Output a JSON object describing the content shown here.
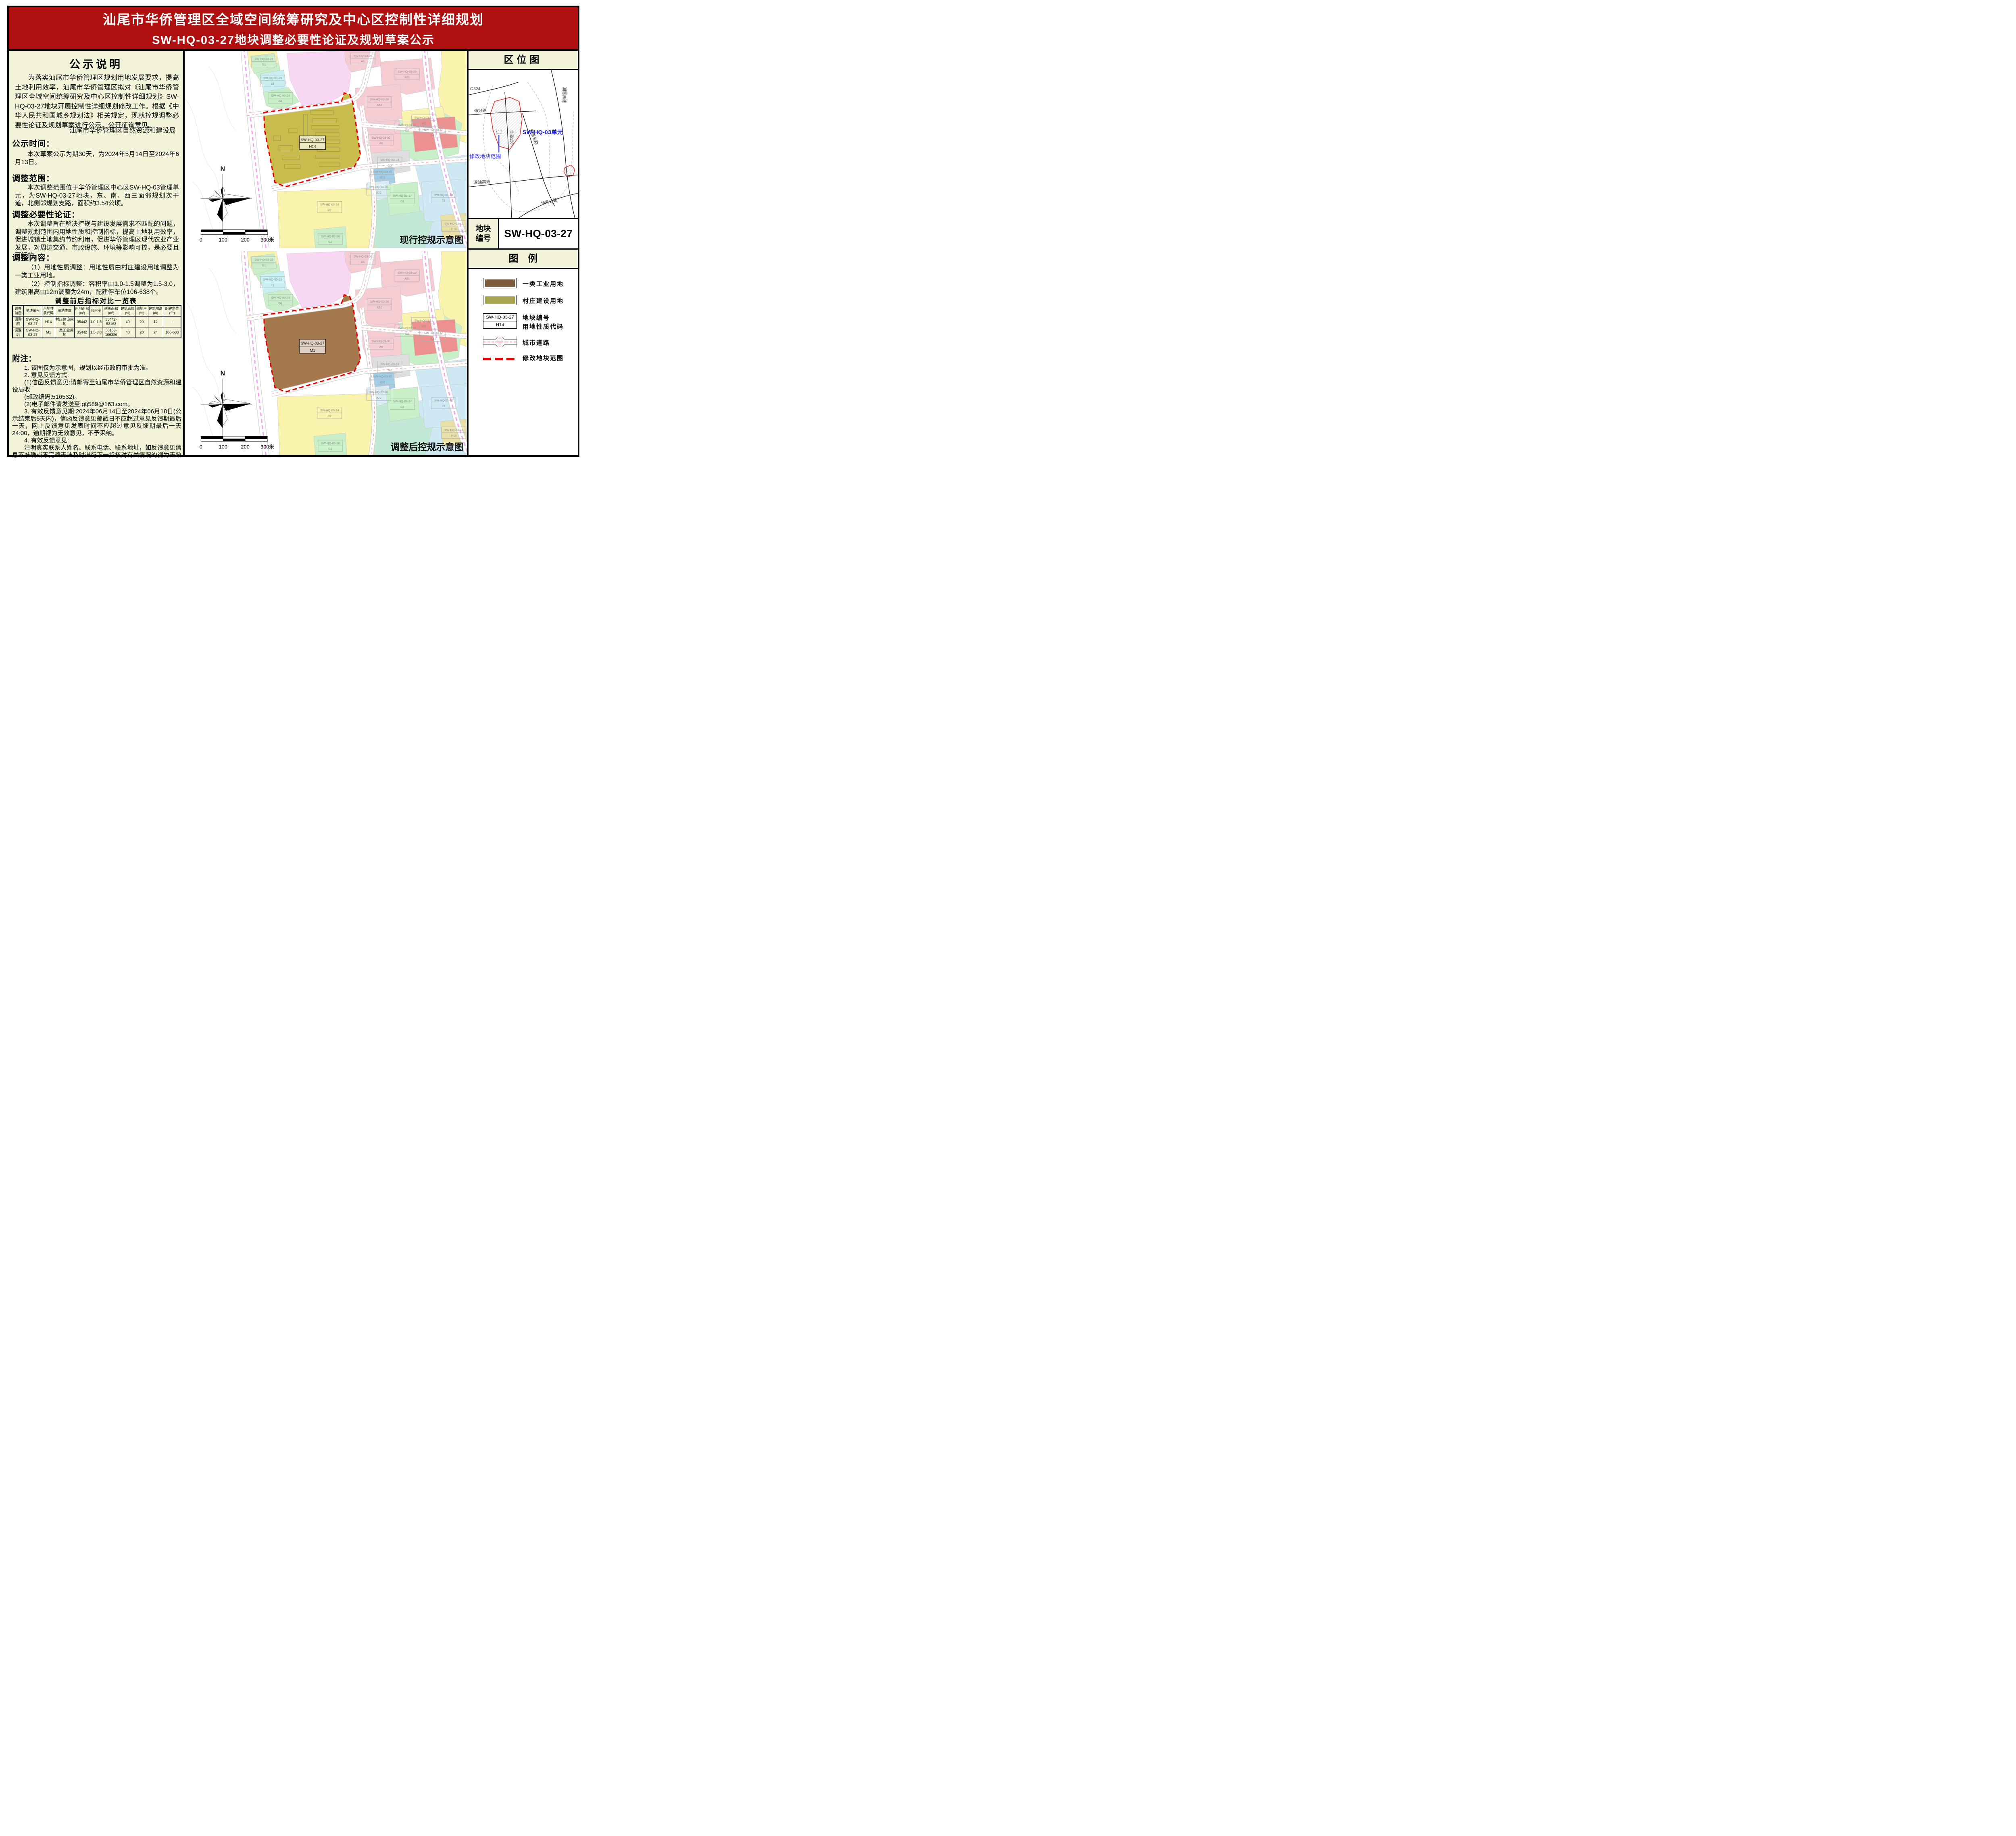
{
  "colors": {
    "header_red": "#b01010",
    "panel_cream": "#f2f3d8",
    "industrial_brown": "#7f5a3a",
    "village_olive": "#a9a44e",
    "map_olive": "#c9bc4c",
    "map_brown": "#a5794e",
    "boundary_red": "#e60000",
    "blue_label": "#1a1ae6"
  },
  "header": {
    "title_line1": "汕尾市华侨管理区全域空间统筹研究及中心区控制性详细规划",
    "title_line2": "SW-HQ-03-27地块调整必要性论证及规划草案公示"
  },
  "left": {
    "notice_title": "公示说明",
    "intro": "为落实汕尾市华侨管理区规划用地发展要求，提高土地利用效率，汕尾市华侨管理区拟对《汕尾市华侨管理区全域空间统筹研究及中心区控制性详细规划》SW-HQ-03-27地块开展控制性详细规划修改工作。根据《中华人民共和国城乡规划法》相关规定，现就控规调整必要性论证及规划草案进行公示，公开征询意见。",
    "agency": "汕尾市华侨管理区自然资源和建设局",
    "sections": [
      {
        "heading": "公示时间：",
        "body": "本次草案公示为期30天，为2024年5月14日至2024年6月13日。"
      },
      {
        "heading": "调整范围：",
        "body": "本次调整范围位于华侨管理区中心区SW-HQ-03管理单元，为SW-HQ-03-27地块，东、南、西三面邻规划次干道，北侧邻规划支路，面积约3.54公顷。"
      },
      {
        "heading": "调整必要性论证：",
        "body": "本次调整旨在解决控规与建设发展需求不匹配的问题，调整规划范围内用地性质和控制指标，提高土地利用效率，促进城镇土地集约节约利用，促进华侨管理区现代农业产业发展，对周边交通、市政设施、环境等影响可控，是必要且可行的。"
      }
    ],
    "adjust_content": {
      "heading": "调整内容：",
      "lines": [
        "（1）用地性质调整：用地性质由村庄建设用地调整为一类工业用地。",
        "（2）控制指标调整：容积率由1.0-1.5调整为1.5-3.0，建筑限高由12m调整为24m，配建停车位106-638个。"
      ]
    },
    "table": {
      "title": "调整前后指标对比一览表",
      "headers": [
        "调整前后",
        "地块编号",
        "用地性质代码",
        "用地性质",
        "用地面积(m²)",
        "容积率",
        "建筑面积(m²)",
        "建筑密度(%)",
        "绿地率(%)",
        "建筑限高(m)",
        "配建车位(个)"
      ],
      "rows": [
        [
          "调整前",
          "SW-HQ-03-27",
          "H14",
          "村庄建设用地",
          "35442",
          "1.0-1.5",
          "35442-53163",
          "40",
          "20",
          "12",
          "--"
        ],
        [
          "调整后",
          "SW-HQ-03-27",
          "M1",
          "一类工业用地",
          "35442",
          "1.5-3.0",
          "53163-106326",
          "40",
          "20",
          "24",
          "106-638"
        ]
      ]
    },
    "notes": {
      "title": "附注：",
      "lines": [
        "1. 该图仅为示意图，规划以经市政府审批为准。",
        "2. 意见反馈方式:",
        "(1)信函反馈意见:请邮寄至汕尾市华侨管理区自然资源和建设局收",
        "(邮政编码:516532)。",
        "(2)电子邮件请发送至:gtj589@163.com。",
        "3. 有效反馈意见期:2024年06月14日至2024年06月18日(公示结束后5天内)，信函反馈意见邮戳日不应超过意见反馈期最后一天，网上反馈意见发表时间不应超过意见反馈期最后一天24:00，逾期视为无效意见，不予采纳。",
        "4. 有效反馈意见:",
        "注明真实联系人姓名、联系电话、联系地址，如反馈意见信息不准确或不完整无法及时进行下一步核对有关情况的视为无效意见。",
        "5. 查询网址:http://www.swhqglq.gov.cn/。"
      ]
    }
  },
  "maps": {
    "north_label": "N",
    "scale_labels": [
      "0",
      "100",
      "200",
      "300米"
    ],
    "current": {
      "caption": "现行控规示意图",
      "center_code": "SW-HQ-03-27",
      "center_use": "H14"
    },
    "adjusted": {
      "caption": "调整后控规示意图",
      "center_code": "SW-HQ-03-27",
      "center_use": "M1"
    },
    "parcel_labels": [
      {
        "code": "SW-HQ-03-22",
        "use": "G1"
      },
      {
        "code": "SW-HQ-03-23",
        "use": "E1"
      },
      {
        "code": "SW-HQ-03-24",
        "use": "G1"
      },
      {
        "code": "SW-HQ-03-26",
        "use": "A6"
      },
      {
        "code": "SW-HQ-03-29",
        "use": "A51"
      },
      {
        "code": "SW-HQ-03-28",
        "use": "A52"
      },
      {
        "code": "SW-HQ-03-11",
        "use": "R2"
      },
      {
        "code": "SW-HQ-03-30",
        "use": "A6"
      },
      {
        "code": "SW-HQ-03-31",
        "use": "G2"
      },
      {
        "code": "SW-HQ-03-32",
        "use": "B41"
      },
      {
        "code": "SW-HQ-03-33",
        "use": "G3"
      },
      {
        "code": "SW-HQ-03-35",
        "use": "U31"
      },
      {
        "code": "SW-HQ-03-36",
        "use": "U22"
      },
      {
        "code": "SW-HQ-03-37",
        "use": "G1"
      },
      {
        "code": "SW-HQ-03-40",
        "use": "E1"
      },
      {
        "code": "SW-HQ-03-34",
        "use": "R2"
      },
      {
        "code": "SW-HQ-03-38",
        "use": "G1"
      },
      {
        "code": "SW-HQ-03-42",
        "use": "H14"
      }
    ]
  },
  "location": {
    "title": "区位图",
    "road_g324": "G324",
    "road_huaxing": "华兴路",
    "road_xiandao": "县道138",
    "road_qiaohui": "侨惠公路",
    "road_chaohui": "潮惠高速",
    "road_shenshan": "深汕高速",
    "road_huaqiao": "华侨公路",
    "unit_label": "SW-HQ-03单元",
    "range_label": "修改地块范围"
  },
  "block": {
    "label": "地块编号",
    "value": "SW-HQ-03-27"
  },
  "legend": {
    "title": "图　例",
    "item_industrial": "一类工业用地",
    "item_village": "村庄建设用地",
    "item_code": "地块编号",
    "item_usecode": "用地性质代码",
    "item_road": "城市道路",
    "item_range": "修改地块范围",
    "box_code": "SW-HQ-03-27",
    "box_use": "H14"
  }
}
